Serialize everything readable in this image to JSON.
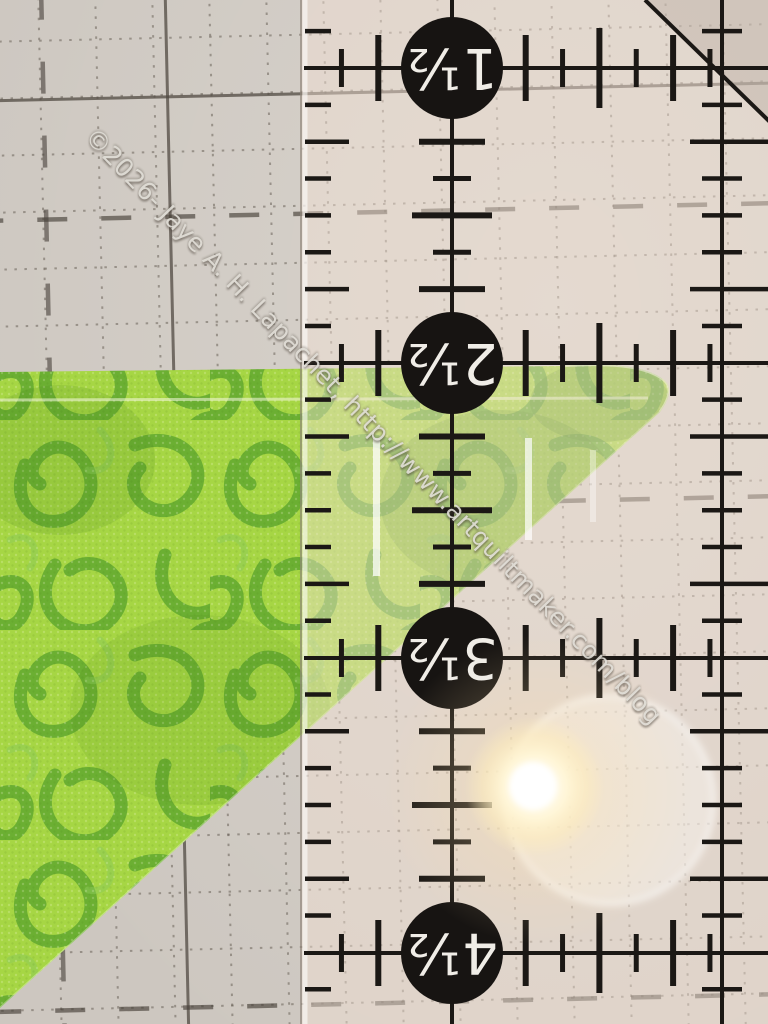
{
  "watermark": {
    "text": "©2026- Jaye A. H. Lapachet, http://www.artquiltmaker.com/blog"
  },
  "ruler": {
    "unit_labels": [
      "1½",
      "2½",
      "3½",
      "4½"
    ]
  },
  "colors": {
    "fabric_base": "#a6d644",
    "fabric_print": "#5ca52c",
    "mat_base": "#cdc7c0",
    "ruler_ink": "#1b1815",
    "circle_fill": "#171412",
    "circle_text": "#f0ede7",
    "watermark_text": "#dedbd4",
    "flare_warm": "#ffe9a8"
  }
}
